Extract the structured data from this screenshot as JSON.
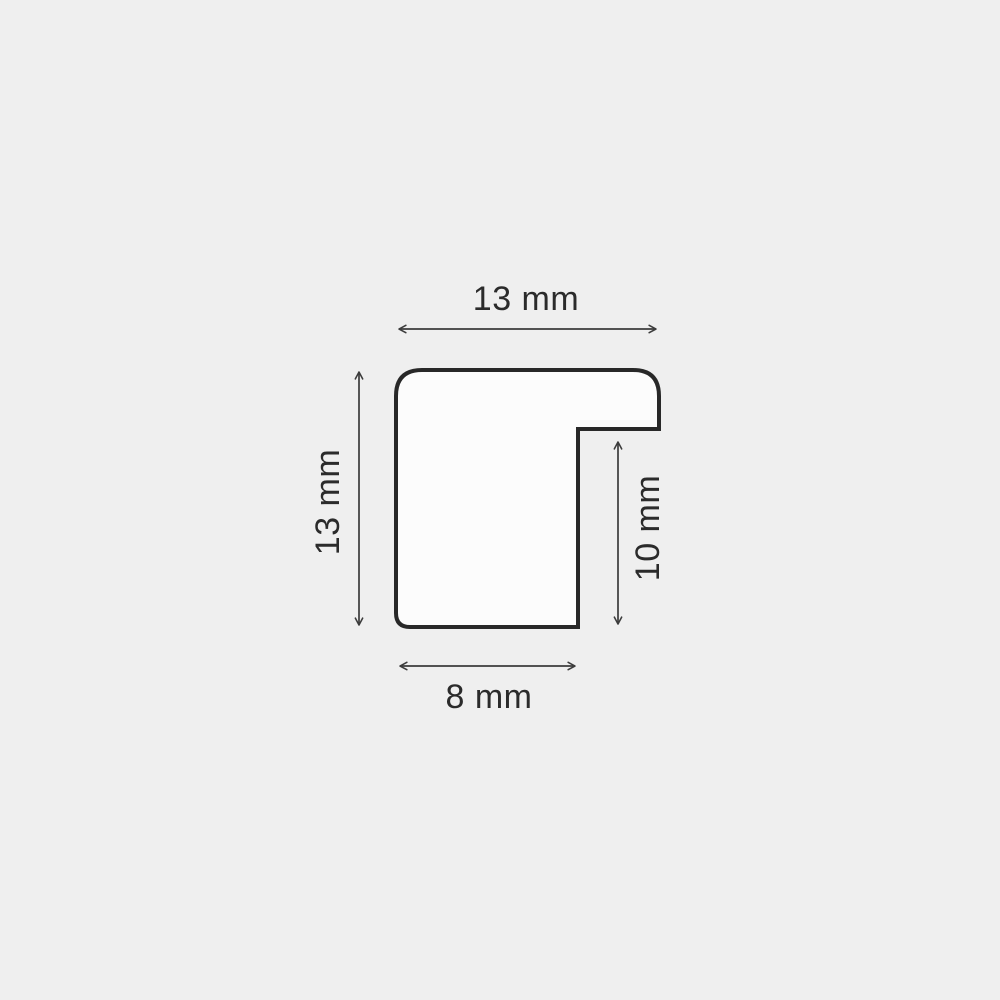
{
  "diagram": {
    "type": "technical-drawing",
    "subject": "frame moulding profile cross-section",
    "unit": "mm",
    "dimensions": {
      "top_width": {
        "label": "13 mm",
        "value": 13
      },
      "left_height": {
        "label": "13 mm",
        "value": 13
      },
      "rabbet_depth": {
        "label": "10 mm",
        "value": 10
      },
      "bottom_width": {
        "label": "8 mm",
        "value": 8
      }
    },
    "colors": {
      "background": "#efefef",
      "shape_fill": "#fcfcfc",
      "outline": "#282828",
      "dim": "#3c3c3c",
      "text": "#2b2b2b"
    }
  }
}
